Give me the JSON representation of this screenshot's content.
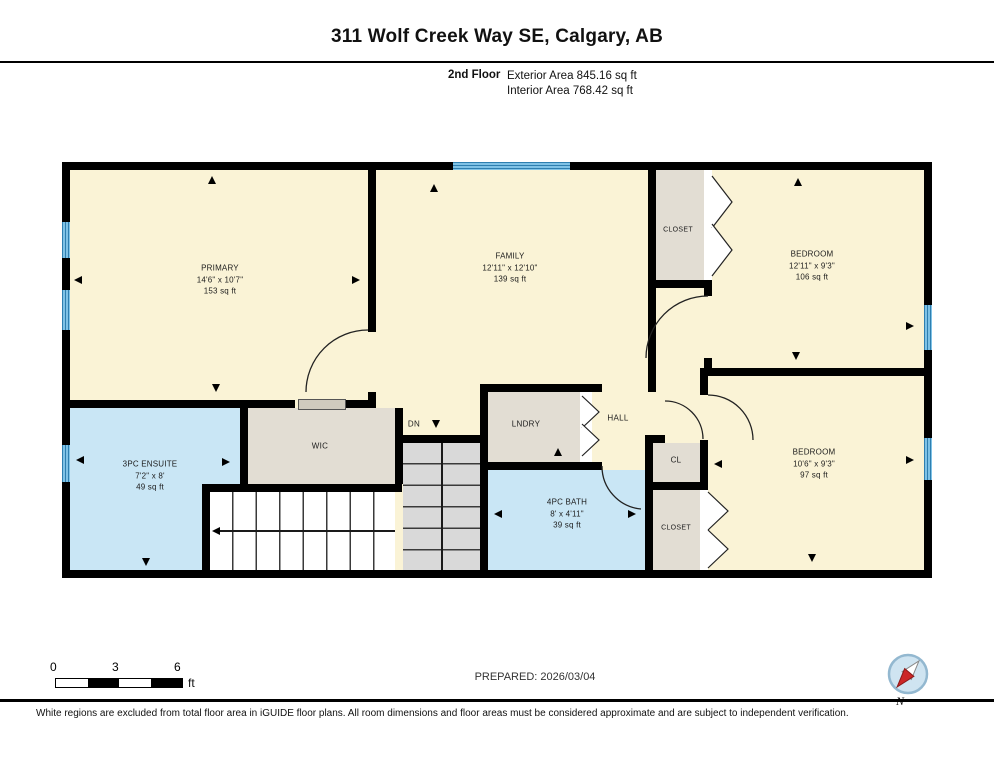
{
  "header": {
    "title": "311 Wolf Creek Way SE, Calgary, AB",
    "floor_label": "2nd Floor",
    "exterior_area": "Exterior Area 845.16 sq ft",
    "interior_area": "Interior Area 768.42 sq ft"
  },
  "rooms": [
    {
      "name": "PRIMARY",
      "dims": "14'6\" x 10'7\"",
      "area": "153 sq ft"
    },
    {
      "name": "FAMILY",
      "dims": "12'11\" x 12'10\"",
      "area": "139 sq ft"
    },
    {
      "name": "BEDROOM",
      "dims": "12'11\" x 9'3\"",
      "area": "106 sq ft"
    },
    {
      "name": "BEDROOM",
      "dims": "10'6\" x 9'3\"",
      "area": "97 sq ft"
    },
    {
      "name": "3PC ENSUITE",
      "dims": "7'2\" x 8'",
      "area": "49 sq ft"
    },
    {
      "name": "4PC BATH",
      "dims": "8' x 4'11\"",
      "area": "39 sq ft"
    }
  ],
  "labels": {
    "wic": "WIC",
    "lndry": "LNDRY",
    "hall": "HALL",
    "closet_top": "CLOSET",
    "cl": "CL",
    "closet_bottom": "CLOSET",
    "dn": "DN"
  },
  "footer": {
    "prepared": "PREPARED: 2026/03/04",
    "disclaimer": "White regions are excluded from total floor area in iGUIDE floor plans. All room dimensions and floor areas must be considered approximate and are subject to independent verification.",
    "scale": {
      "zero": "0",
      "three": "3",
      "six": "6",
      "unit": "ft"
    },
    "compass_n": "N"
  },
  "colors": {
    "wall": "#000000",
    "room_fill": "#faf3d6",
    "wet_room_fill": "#c9e6f5",
    "closet_fill": "#e2ddd3",
    "window_blue": "#4d9fd3",
    "stair_grey": "#d9d9d9"
  }
}
